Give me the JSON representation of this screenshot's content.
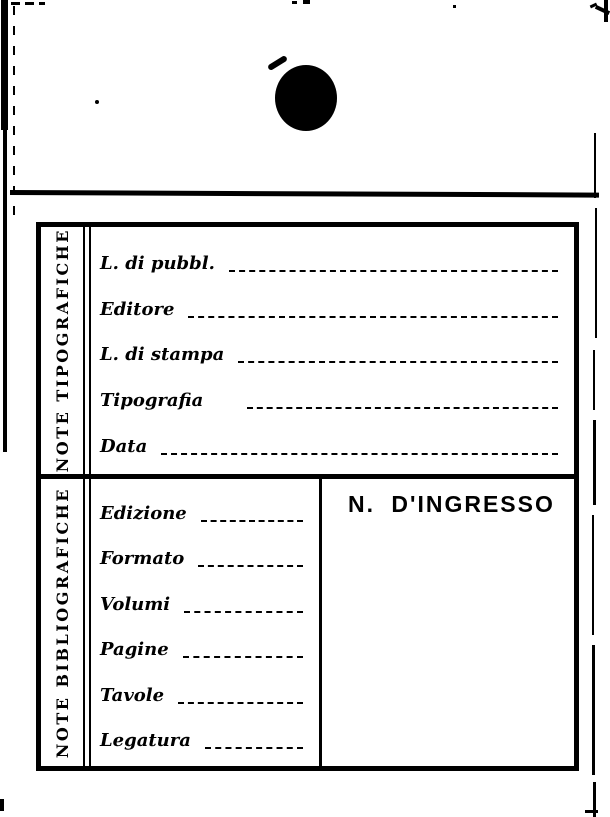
{
  "page": {
    "paper_color": "#ffffff",
    "ink_color": "#000000"
  },
  "card": {
    "sections": [
      {
        "label": "NOTE TIPOGRAFICHE",
        "fields": [
          {
            "label": "L. di pubbl.",
            "value": ""
          },
          {
            "label": "Editore",
            "value": ""
          },
          {
            "label": "L. di stampa",
            "value": ""
          },
          {
            "label": "Tipografia",
            "value": ""
          },
          {
            "label": "Data",
            "value": ""
          }
        ]
      },
      {
        "label": "NOTE BIBLIOGRAFICHE",
        "fields": [
          {
            "label": "Edizione",
            "value": ""
          },
          {
            "label": "Formato",
            "value": ""
          },
          {
            "label": "Volumi",
            "value": ""
          },
          {
            "label": "Pagine",
            "value": ""
          },
          {
            "label": "Tavole",
            "value": ""
          },
          {
            "label": "Legatura",
            "value": ""
          }
        ]
      }
    ],
    "ingresso_label": "N. D'INGRESSO"
  }
}
